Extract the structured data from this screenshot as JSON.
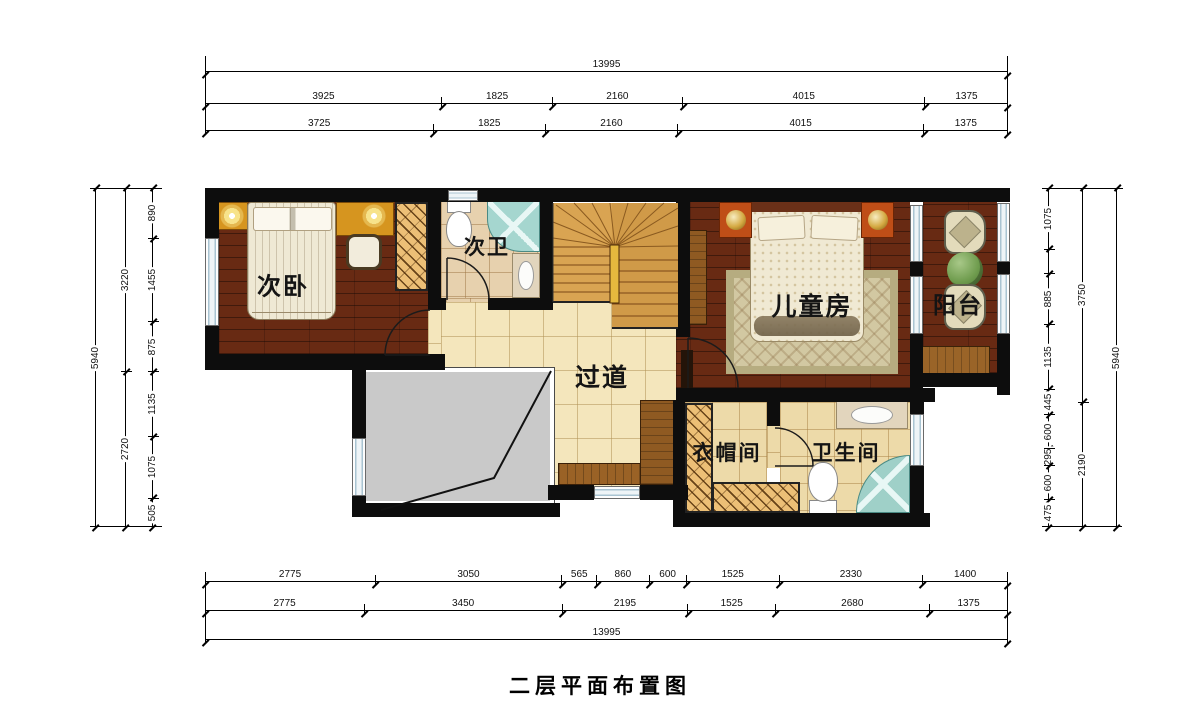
{
  "title": "二层平面布置图",
  "rooms": {
    "second_bedroom": "次卧",
    "second_bath": "次卫",
    "corridor": "过道",
    "kids_room": "儿童房",
    "balcony": "阳台",
    "cloakroom": "衣帽间",
    "bathroom": "卫生间"
  },
  "dimensions": {
    "top": [
      [
        13995
      ],
      [
        3925,
        1825,
        2160,
        4015,
        1375
      ],
      [
        3725,
        1825,
        2160,
        4015,
        1375
      ]
    ],
    "bottom": [
      [
        2775,
        3050,
        565,
        860,
        600,
        1525,
        2330,
        1400
      ],
      [
        2775,
        3450,
        2195,
        1525,
        2680,
        1375
      ],
      [
        13995
      ]
    ],
    "left": [
      [
        5940
      ],
      [
        3220,
        2720
      ],
      [
        890,
        1455,
        875,
        1135,
        1075,
        505
      ]
    ],
    "right": [
      [
        1075,
        {
          "v": 430,
          "t": ""
        },
        885,
        1135,
        445,
        600,
        295,
        600,
        475
      ],
      [
        3750,
        2190
      ],
      [
        5940
      ]
    ]
  },
  "colors": {
    "wall": "#0d0d0d",
    "wood_floor": "#682a13",
    "tile_corridor": "#f4e6bc",
    "tile_bath": "#eddaa9",
    "stair_wood": "#d9a452",
    "void_gray": "#c9c9c9",
    "shower_glass": "#9fd0c8",
    "wardrobe_hatch": "#ecbf76",
    "nightstand_orange": "#bf4e17",
    "window_blue": "#a9c4d2"
  }
}
